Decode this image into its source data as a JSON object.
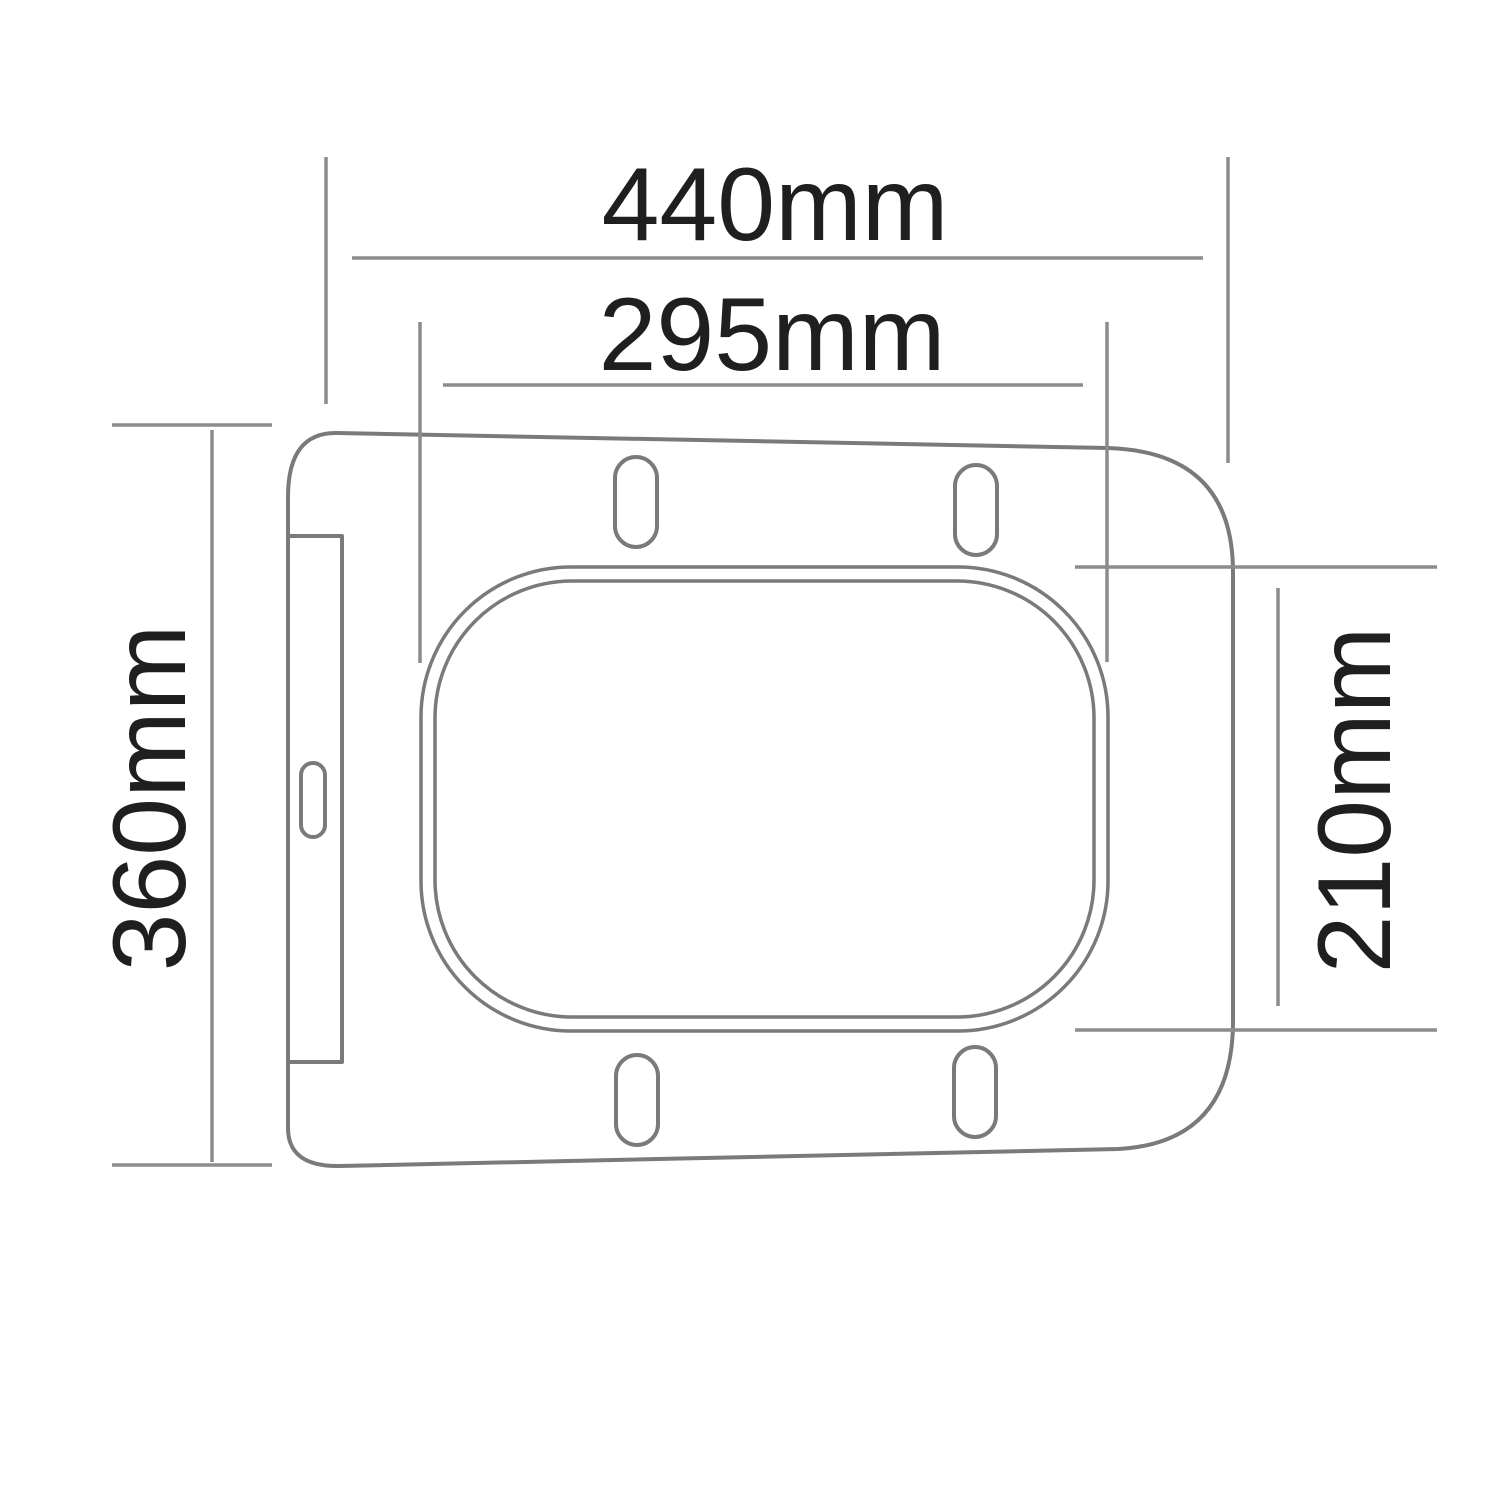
{
  "diagram": {
    "unit": "mm",
    "dimensions": {
      "overall_width": {
        "label": "440mm",
        "value": 440
      },
      "inner_width": {
        "label": "295mm",
        "value": 295
      },
      "overall_height": {
        "label": "360mm",
        "value": 360
      },
      "inner_height": {
        "label": "210mm",
        "value": 210
      }
    },
    "colors": {
      "background": "#ffffff",
      "drawing_line": "#7a7a7a",
      "dimension_line": "#8c8c8c",
      "text": "#1f1f1f"
    }
  }
}
